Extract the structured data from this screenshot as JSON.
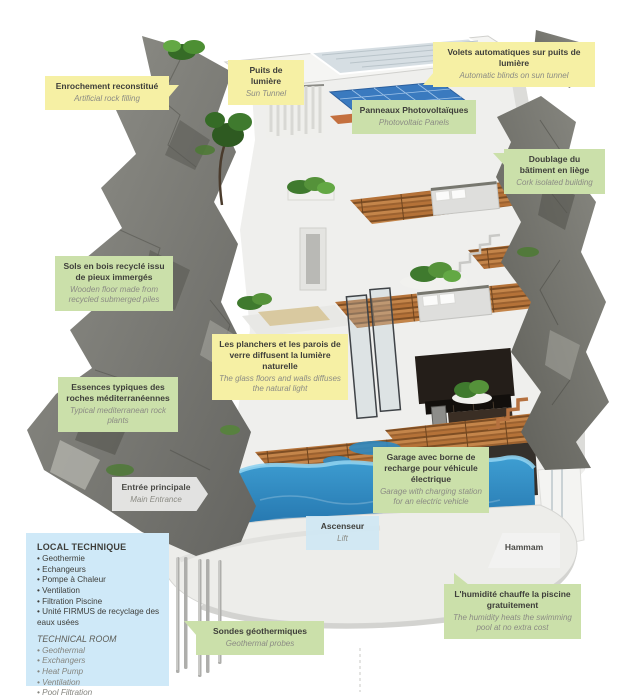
{
  "figure": {
    "description": "Cutaway 3D cross-section of an ecological house built into a mediterranean rock cliff, showing multiple floors, rooftop sun tunnel and photovoltaic panels, glass floors, garage with electric-vehicle charger, swimming pool, hammam and geothermal probes",
    "colors": {
      "label_yellow": "#f6f0a4",
      "label_green": "#cbe0aa",
      "label_blue": "#cfe9f8",
      "rock_gray": "#7b7b74",
      "wood_brown": "#b57238",
      "pool_blue": "#2787c4",
      "pv_blue": "#3a7abf",
      "plant_green": "#4d8f33"
    }
  },
  "labels": [
    {
      "id": "enrochement",
      "fr": "Enrochement reconstitué",
      "en": "Artificial rock filling",
      "color": "yellow"
    },
    {
      "id": "puits",
      "fr": "Puits de lumière",
      "en": "Sun Tunnel",
      "color": "yellow"
    },
    {
      "id": "volets",
      "fr": "Volets automatiques sur puits de lumière",
      "en": "Automatic blinds on sun tunnel",
      "color": "yellow"
    },
    {
      "id": "panneaux",
      "fr": "Panneaux Photovoltaïques",
      "en": "Photovoltaic Panels",
      "color": "green"
    },
    {
      "id": "doublage",
      "fr": "Doublage du bâtiment en liège",
      "en": "Cork isolated building",
      "color": "green"
    },
    {
      "id": "sols",
      "fr": "Sols en bois recyclé issu de pieux immergés",
      "en": "Wooden floor made from recycled submerged piles",
      "color": "green"
    },
    {
      "id": "planchers",
      "fr": "Les planchers et les parois de verre diffusent la lumière naturelle",
      "en": "The glass floors and walls diffuses the natural light",
      "color": "yellow"
    },
    {
      "id": "essences",
      "fr": "Essences typiques des roches méditerranéennes",
      "en": "Typical mediterranean rock plants",
      "color": "green"
    },
    {
      "id": "entree",
      "fr": "Entrée principale",
      "en": "Main Entrance",
      "color": "white"
    },
    {
      "id": "garage",
      "fr": "Garage avec borne de recharge pour véhicule électrique",
      "en": "Garage with charging station for an electric vehicle",
      "color": "green"
    },
    {
      "id": "ascenseur",
      "fr": "Ascenseur",
      "en": "Lift",
      "color": "blue"
    },
    {
      "id": "hammam",
      "fr": "Hammam",
      "en": "",
      "color": "white"
    },
    {
      "id": "sondes",
      "fr": "Sondes géothermiques",
      "en": "Geothermal probes",
      "color": "green"
    },
    {
      "id": "humidite",
      "fr": "L'humidité chauffe la piscine gratuitement",
      "en": "The humidity heats the swimming pool at no extra cost",
      "color": "green"
    }
  ],
  "tech_room": {
    "fr_title": "LOCAL TECHNIQUE",
    "fr_items": [
      "Geothermie",
      "Echangeurs",
      "Pompe à Chaleur",
      "Ventilation",
      "Filtration Piscine",
      "Unité FIRMUS de recyclage des eaux usées"
    ],
    "en_title": "TECHNICAL ROOM",
    "en_items": [
      "Geothermal",
      "Exchangers",
      "Heat Pump",
      "Ventilation",
      "Pool Filtration",
      "FIRMUS grey-water recycling unit"
    ]
  }
}
